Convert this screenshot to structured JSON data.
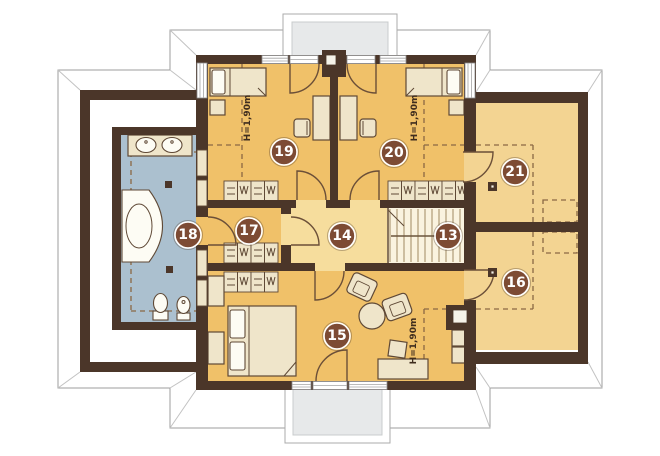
{
  "floorplan": {
    "rooms": [
      {
        "number": "13"
      },
      {
        "number": "14"
      },
      {
        "number": "15"
      },
      {
        "number": "16"
      },
      {
        "number": "17"
      },
      {
        "number": "18"
      },
      {
        "number": "19"
      },
      {
        "number": "20"
      },
      {
        "number": "21"
      }
    ],
    "height_labels": [
      "H=1,90m",
      "H=1,90m",
      "H=1,90m"
    ],
    "colors": {
      "wall": "#4b3629",
      "room_main": "#f0c169",
      "hall": "#f6dd9d",
      "stairs": "#faf3df",
      "storage": "#f3d492",
      "bathroom": "#abc0cf",
      "balcony_floor": "#e7e9ea",
      "furniture": "#efe5ca",
      "badge": "#7d4b34",
      "badge_text": "#ffffff",
      "dashed_line": "#8a6844"
    },
    "icons": [
      "bed-icon",
      "wardrobe-icon",
      "desk-icon",
      "chair-icon",
      "armchair-icon",
      "round-table-icon",
      "stool-icon",
      "bathtub-icon",
      "sink-icon",
      "toilet-icon",
      "bidet-icon",
      "stairs-icon",
      "door-arc",
      "window",
      "chimney"
    ]
  }
}
